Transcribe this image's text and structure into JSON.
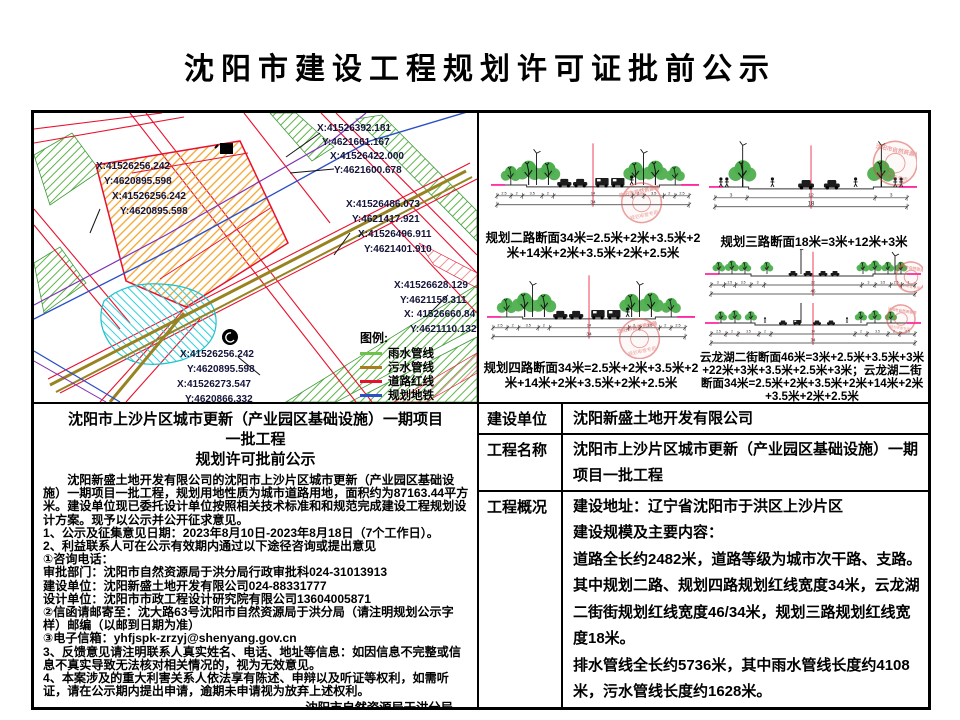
{
  "page": {
    "title": "沈阳市建设工程规划许可证批前公示"
  },
  "map": {
    "labels": [
      {
        "text": "X:41526392.181",
        "x": 283,
        "y": 10
      },
      {
        "text": "Y:4621661.167",
        "x": 288,
        "y": 24
      },
      {
        "text": "X:41526422.000",
        "x": 296,
        "y": 38
      },
      {
        "text": "Y:4621600.678",
        "x": 300,
        "y": 52
      },
      {
        "text": "X:41526256.242",
        "x": 62,
        "y": 48
      },
      {
        "text": "Y:4620895.598",
        "x": 70,
        "y": 63
      },
      {
        "text": "X:41526256.242",
        "x": 78,
        "y": 78
      },
      {
        "text": "Y:4620895.598",
        "x": 86,
        "y": 93
      },
      {
        "text": "X:41526486.073",
        "x": 312,
        "y": 86
      },
      {
        "text": "Y:4621417.921",
        "x": 318,
        "y": 101
      },
      {
        "text": "X:41526496.911",
        "x": 324,
        "y": 116
      },
      {
        "text": "Y:4621401.910",
        "x": 330,
        "y": 131
      },
      {
        "text": "X:41526628.129",
        "x": 360,
        "y": 167
      },
      {
        "text": "Y:4621159.311",
        "x": 366,
        "y": 182
      },
      {
        "text": "X: 41526660.84",
        "x": 370,
        "y": 196
      },
      {
        "text": "Y:4621110.132",
        "x": 376,
        "y": 211
      },
      {
        "text": "X:41526256.242",
        "x": 146,
        "y": 236
      },
      {
        "text": "Y:4620895.598",
        "x": 153,
        "y": 251
      },
      {
        "text": "X:41526273.547",
        "x": 143,
        "y": 266
      },
      {
        "text": "Y:4620866.332",
        "x": 151,
        "y": 281
      }
    ],
    "legend": {
      "title": "图例:",
      "items": [
        {
          "label": "雨水管线",
          "color": "#6cc24a"
        },
        {
          "label": "污水管线",
          "color": "#a97c20"
        },
        {
          "label": "道路红线",
          "color": "#e8112d"
        },
        {
          "label": "规划地铁",
          "color": "#2b50c8"
        }
      ]
    }
  },
  "seals": {
    "line1": "沈阳市自然资源局",
    "line2": "规划审查专用"
  },
  "sections": [
    {
      "key": "sec2",
      "caption": "规划二路断面34米=2.5米+2米+3.5米+2米+14米+2米+3.5米+2米+2.5米",
      "dims": [
        "2.5",
        "2",
        "3.5",
        "2",
        "14",
        "2",
        "3.5",
        "2",
        "2.5"
      ],
      "total": "34"
    },
    {
      "key": "sec3",
      "caption": "规划三路断面18米=3米+12米+3米",
      "dims": [
        "3",
        "12",
        "3"
      ],
      "total": "18"
    },
    {
      "key": "sec4",
      "caption": "规划四路断面34米=2.5米+2米+3.5米+2米+14米+2米+3.5米+2米+2.5米",
      "dims": [
        "2.5",
        "2",
        "3.5",
        "2",
        "14",
        "2",
        "3.5",
        "2",
        "2.5"
      ],
      "total": "34"
    },
    {
      "key": "yll46",
      "caption": "云龙湖二街断面46米=3米+2.5米+3.5米+3米+22米+3米+3.5米+2.5米+3米；云龙湖二街断面34米=2.5米+2米+3.5米+2米+14米+2米+3.5米+2米+2.5米",
      "dims": [
        "3",
        "2.5",
        "3.5",
        "3",
        "22",
        "3",
        "3.5",
        "2.5",
        "3"
      ],
      "total": "46"
    },
    {
      "key": "yll34",
      "dims": [
        "2.5",
        "2",
        "3.5",
        "2",
        "14",
        "2",
        "3.5",
        "2",
        "2.5"
      ],
      "total": "34"
    }
  ],
  "notice": {
    "heading_line1": "沈阳市上沙片区城市更新（产业园区基础设施）一期项目一批工程",
    "heading_line2": "规划许可批前公示",
    "paragraph": "沈阳新盛土地开发有限公司的沈阳市上沙片区城市更新（产业园区基础设施）一期项目一批工程，规划用地性质为城市道路用地，面积约为87163.44平方米。建设单位现已委托设计单位按照相关技术标准和和规范完成建设工程规划设计方案。现予以公示并公开征求意见。",
    "lines": [
      "1、公示及征集意见日期：2023年8月10日-2023年8月18日（7个工作日）。",
      "2、利益联系人可在公示有效期内通过以下途径咨询或提出意见",
      "①咨询电话：",
      "审批部门：沈阳市自然资源局于洪分局行政审批科024-31013913",
      "建设单位：沈阳新盛土地开发有限公司024-88331777",
      "设计单位：沈阳市市政工程设计研究院有限公司13604005871",
      "②信函请邮寄至：沈大路63号沈阳市自然资源局于洪分局（请注明规划公示字样）邮编（以邮到日期为准）",
      "③电子信箱：yhfjspk-zrzyj@shenyang.gov.cn",
      "3、反馈意见请注明联系人真实姓名、电话、地址等信息：如因信息不完整或信息不真实导致无法核对相关情况的，视为无效意见。",
      "4、本案涉及的重大利害关系人依法享有陈述、申辩以及听证等权利，如需听证，请在公示期内提出申请，逾期未申请视为放弃上述权利。"
    ],
    "signature": [
      "沈阳市自然资源局于洪分局",
      "2023年8月10日"
    ]
  },
  "info_table": {
    "rows": [
      {
        "label": "建设单位",
        "lines": [
          "沈阳新盛土地开发有限公司"
        ]
      },
      {
        "label": "工程名称",
        "lines": [
          "沈阳市上沙片区城市更新（产业园区基础设施）一期项目一批工程"
        ]
      },
      {
        "label": "工程概况",
        "lines": [
          "建设地址：辽宁省沈阳市于洪区上沙片区",
          "建设规模及主要内容：",
          "道路全长约2482米，道路等级为城市次干路、支路。其中规划二路、规划四路规划红线宽度34米，云龙湖二街街规划红线宽度46/34米，规划三路规划红线宽度18米。",
          "排水管线全长约5736米，其中雨水管线长度约4108米，污水管线长度约1628米。",
          "工程内容主要包括道路工程、排水工程等。"
        ]
      }
    ]
  }
}
